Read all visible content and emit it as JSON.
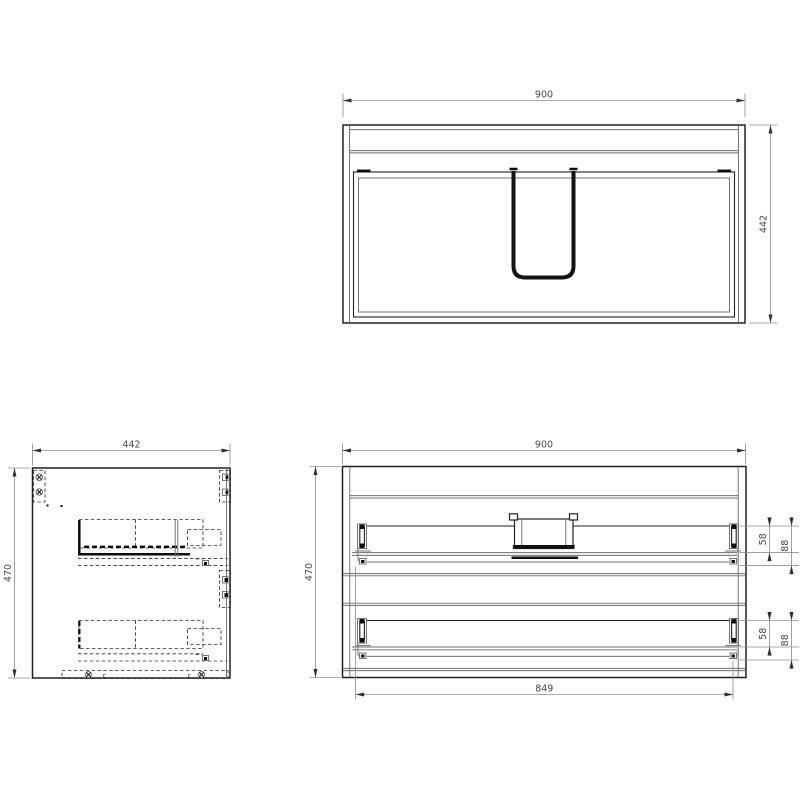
{
  "colors": {
    "background": "#ffffff",
    "line_dark": "#202020",
    "line_thin": "#6e6e6e",
    "line_heavy": "#0c0c0c",
    "dimension_line": "#8f8f8f",
    "dimension_text": "#484848"
  },
  "views": {
    "top_view": {
      "dims": {
        "width": "900",
        "depth": "442"
      }
    },
    "side_view": {
      "dims": {
        "width": "442",
        "height": "470"
      },
      "markers": {
        "clip_a": "c",
        "clip_b": "c"
      }
    },
    "front_view": {
      "dims": {
        "width": "900",
        "height": "470",
        "slide_span": "849",
        "drawer_top": {
          "offset": "58",
          "depth": "88"
        },
        "drawer_bottom": {
          "offset": "58",
          "depth": "88"
        }
      }
    }
  }
}
